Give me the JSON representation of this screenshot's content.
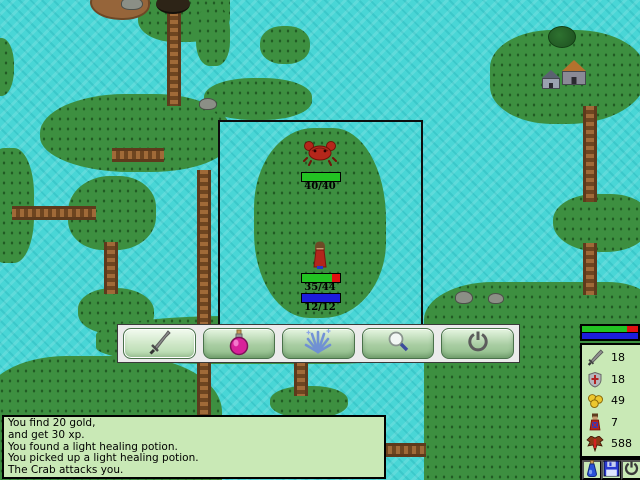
{
  "battle_window": {
    "enemy": {
      "name": "crab",
      "hp_label": "40/40",
      "hp_pct": 100
    },
    "player": {
      "hp_label": "35/44",
      "hp_pct": 80,
      "mp_label": "12/12",
      "mp_pct": 100
    }
  },
  "toolbar": {
    "buttons": [
      {
        "icon": "sword-attack",
        "active": true
      },
      {
        "icon": "healing-potion",
        "active": false
      },
      {
        "icon": "magic-spell",
        "active": false
      },
      {
        "icon": "search-magnifier",
        "active": false
      },
      {
        "icon": "power-quit",
        "active": false
      }
    ]
  },
  "message_log": {
    "lines": [
      "You find 20 gold,",
      "and get 30 xp.",
      "You found a light healing potion.",
      "You picked up a light healing potion.",
      "The Crab attacks you."
    ]
  },
  "status_panel": {
    "hp_pct": 80,
    "mp_pct": 100,
    "stats": [
      {
        "icon": "sword",
        "value": "18"
      },
      {
        "icon": "shield",
        "value": "18"
      },
      {
        "icon": "gold-coins",
        "value": "49"
      },
      {
        "icon": "character",
        "value": "7"
      },
      {
        "icon": "monster-xp",
        "value": "588"
      }
    ],
    "buttons": [
      {
        "icon": "potion"
      },
      {
        "icon": "save-disk"
      },
      {
        "icon": "power"
      }
    ]
  },
  "colors": {
    "water": "#49d6d6",
    "grass": "#3d8f40",
    "bridge": "#8a5a2e",
    "hp_green": "#22c322",
    "hp_red": "#e01010",
    "mp_blue": "#1c1cdc",
    "panel_bg": "#c9e9b6",
    "button_green": "#a8cda2"
  }
}
